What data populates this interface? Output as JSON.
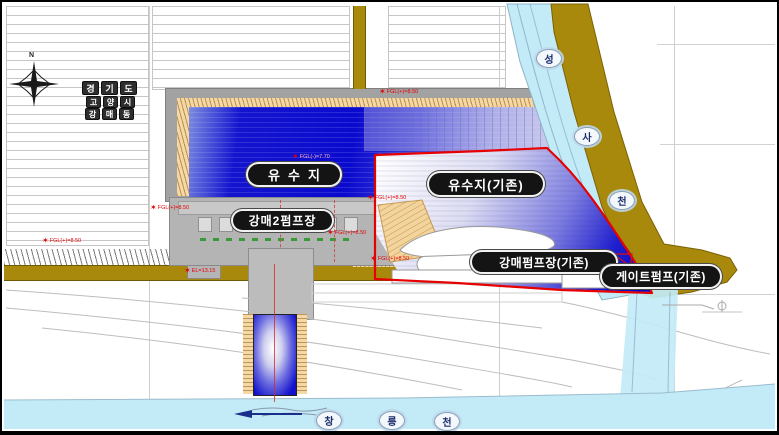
{
  "labels": {
    "basin_new": "유수지",
    "basin_existing": "유수지(기존)",
    "pump_new": "강매2펌프장",
    "pump_existing": "강매펌프장(기존)",
    "gate_pump_existing": "게이트펌프(기존)"
  },
  "location_stack": {
    "rows": [
      [
        "경",
        "기",
        "도"
      ],
      [
        "고",
        "양",
        "시"
      ],
      [
        "강",
        "매",
        "동"
      ]
    ]
  },
  "streams": {
    "seongsa": [
      "성",
      "사",
      "천"
    ],
    "changneung": [
      "창",
      "릉",
      "천"
    ]
  },
  "compass": {
    "north": "N"
  },
  "markers": {
    "m1": "FGL(+)=8.50",
    "m2": "FGL(-)=7.70",
    "m3": "FGL(+)=8.50",
    "m4": "FGL(+)=8.50",
    "m5": "FGL(+)=8.50",
    "m6": "FGL(+)=8.50",
    "m7": "FGL(+)=8.50",
    "m8": "EL=13.15"
  },
  "colors": {
    "water_deep": "#0a0acf",
    "stream_light": "#c3eaf7",
    "road_olive": "#a8890b",
    "boundary_red": "#e60000",
    "slope_tan": "#f4d9a6"
  }
}
